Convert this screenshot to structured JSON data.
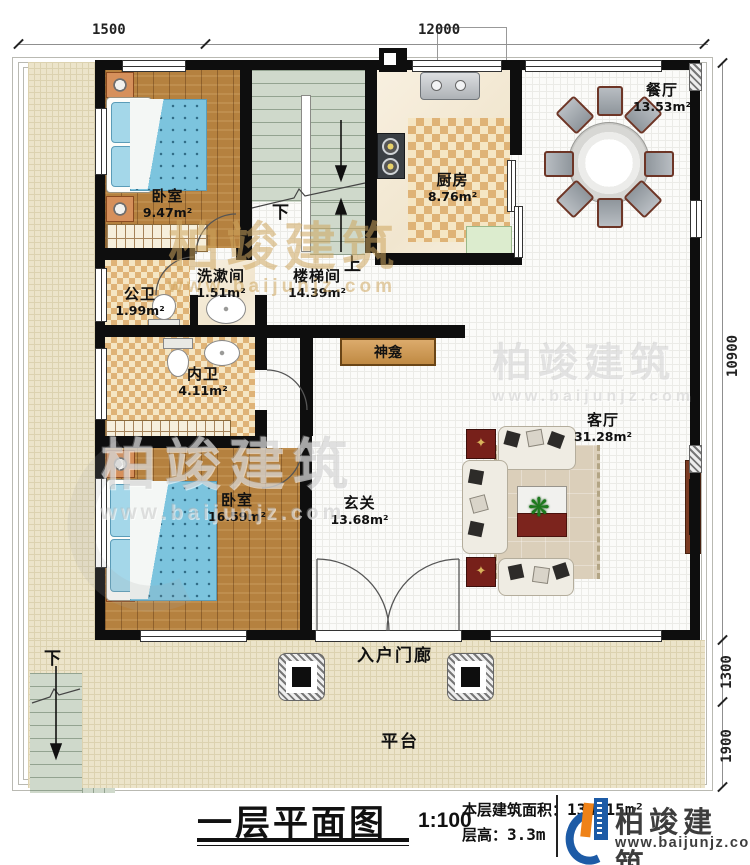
{
  "plan": {
    "dimensions": {
      "top_left": "1500",
      "top_main": "12000",
      "right_main": "10900",
      "right_porch": "1300",
      "right_platform": "1900"
    },
    "rooms": {
      "bedroom1": {
        "name": "卧室",
        "area": "9.47m²"
      },
      "stairwell": {
        "name": "楼梯间",
        "area": "14.39m²"
      },
      "kitchen": {
        "name": "厨房",
        "area": "8.76m²"
      },
      "dining": {
        "name": "餐厅",
        "area": "13.53m²"
      },
      "public_bath": {
        "name": "公卫",
        "area": "1.99m²"
      },
      "washroom": {
        "name": "洗漱间",
        "area": "1.51m²"
      },
      "inner_bath": {
        "name": "内卫",
        "area": "4.11m²"
      },
      "bedroom2": {
        "name": "卧室",
        "area": "16.59m²"
      },
      "foyer": {
        "name": "玄关",
        "area": "13.68m²"
      },
      "living": {
        "name": "客厅",
        "area": "31.28m²"
      },
      "shrine": {
        "name": "神龛"
      },
      "porch": {
        "name": "入户门廊"
      },
      "platform": {
        "name": "平台"
      }
    },
    "stairs": {
      "down": "下",
      "up": "上",
      "outdoor_down": "下"
    }
  },
  "titleblock": {
    "title": "一层平面图",
    "scale": "1:100",
    "area_label": "本层建筑面积：",
    "area_value": "134.15m²",
    "height_label": "层高：",
    "height_value": "3.3m"
  },
  "brand": {
    "name": "柏竣建筑",
    "url": "www.baijunjz.com"
  },
  "watermark": {
    "name": "柏竣建筑",
    "url": "www.baijunjz.com"
  },
  "colors": {
    "accent_blue": "#1d5ba6",
    "accent_orange": "#ef8218",
    "wall": "#0e0e0e",
    "wood": "#b5813f",
    "bed": "#7cc4de"
  }
}
